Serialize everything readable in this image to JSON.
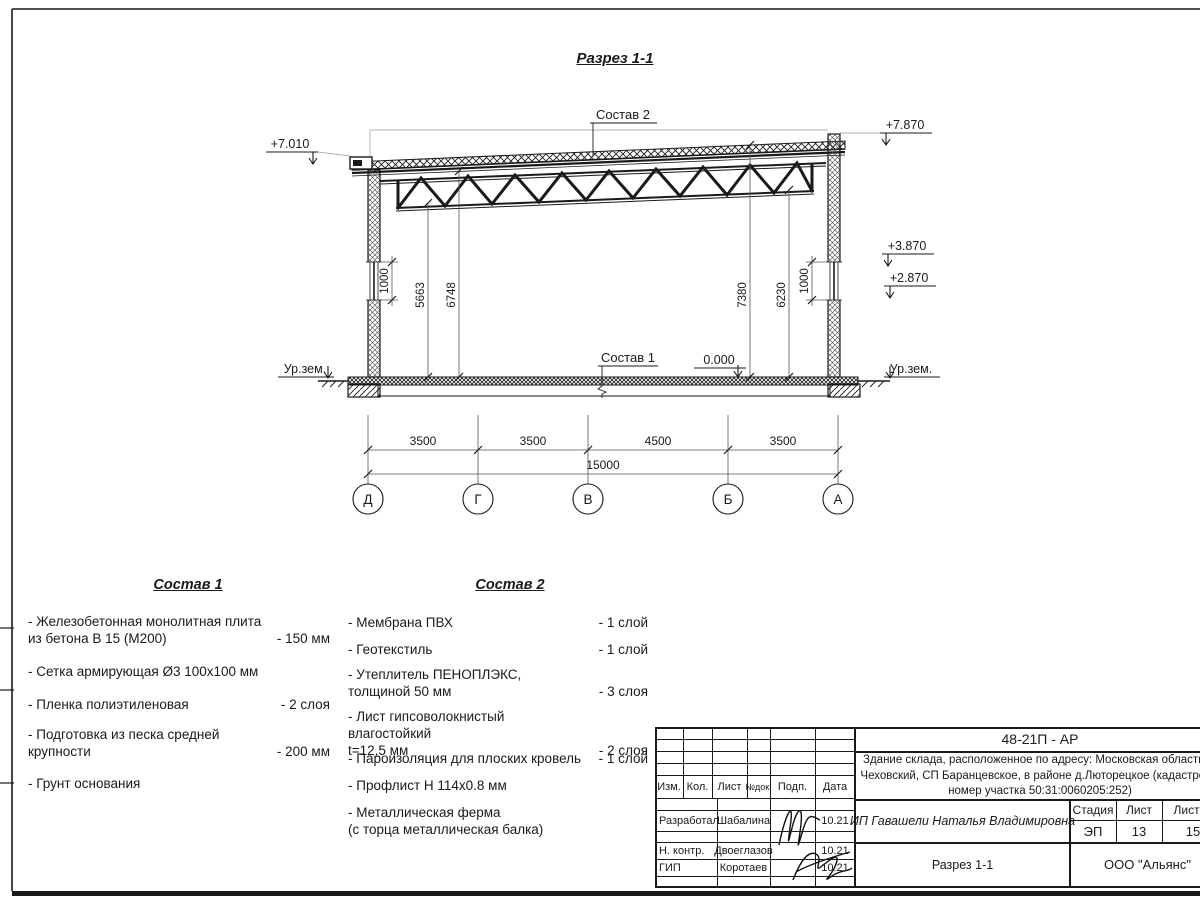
{
  "section": {
    "title": "Разрез 1-1",
    "elev_roof_left": "+7.010",
    "elev_roof_right": "+7.870",
    "elev_right_upper": "+3.870",
    "elev_right_lower": "+2.870",
    "elev_floor": "0.000",
    "ground_label_left": "Ур.зем.",
    "ground_label_right": "Ур.зем.",
    "callout_roof": "Состав 2",
    "callout_floor": "Состав 1",
    "dim_left_window": "1000",
    "dim_h1": "5663",
    "dim_h2": "6748",
    "dim_h3": "7380",
    "dim_h4": "6230",
    "dim_right_window": "1000"
  },
  "grid": {
    "axes": [
      "Д",
      "Г",
      "В",
      "Б",
      "А"
    ],
    "spans": [
      "3500",
      "3500",
      "4500",
      "3500"
    ],
    "total": "15000"
  },
  "sostav1": {
    "title": "Состав 1",
    "items": [
      {
        "name": "- Железобетонная  монолитная плита\n  из бетона В 15 (М200)",
        "value": "- 150 мм"
      },
      {
        "name": "- Сетка армирующая Ø3 100х100 мм",
        "value": ""
      },
      {
        "name": "- Пленка полиэтиленовая",
        "value": "-  2 слоя"
      },
      {
        "name": "- Подготовка из песка средней\n  крупности",
        "value": "- 200 мм"
      },
      {
        "name": "- Грунт основания",
        "value": ""
      }
    ]
  },
  "sostav2": {
    "title": "Состав 2",
    "items": [
      {
        "name": "- Мембрана ПВХ",
        "value": "- 1 слой"
      },
      {
        "name": "- Геотекстиль",
        "value": "- 1 слой"
      },
      {
        "name": "- Утеплитель ПЕНОПЛЭКС,\n  толщиной 50 мм",
        "value": "- 3 слоя"
      },
      {
        "name": "- Лист гипсоволокнистый влагостойкий\n t=12,5 мм",
        "value": "- 2 слоя"
      },
      {
        "name": "- Пароизоляция для плоских кровель",
        "value": "- 1 слой"
      },
      {
        "name": "- Профлист Н 114х0.8 мм",
        "value": ""
      },
      {
        "name": "- Металлическая ферма\n  (с торца металлическая балка)",
        "value": ""
      }
    ]
  },
  "titleblock": {
    "doc_number": "48-21П - АР",
    "project_line1": "Здание склада, расположенное по адресу: Московская область, р",
    "project_line2": "Чеховский, СП Баранцевское, в районе д.Люторецкое  (кадастровы",
    "project_line3": "номер участка 50:31:0060205:252)",
    "client": "ИП Гавашели Наталья Владимировна",
    "sheet_title": "Разрез 1-1",
    "company": "ООО \"Альянс\"",
    "col_izm": "Изм.",
    "col_kol": "Кол.",
    "col_list": "Лист",
    "col_ndok": "№док.",
    "col_podp": "Подп.",
    "col_data": "Дата",
    "stage_label": "Стадия",
    "stage_value": "ЭП",
    "sheet_label": "Лист",
    "sheet_value": "13",
    "sheets_label": "Листов",
    "sheets_value": "15",
    "rows": [
      {
        "role": "Разработал",
        "name": "Шабалина",
        "date": "10.21"
      },
      {
        "role": "Н. контр.",
        "name": "Двоеглазов",
        "date": "10.21"
      },
      {
        "role": "ГИП",
        "name": "Коротаев",
        "date": "10.21"
      }
    ]
  }
}
